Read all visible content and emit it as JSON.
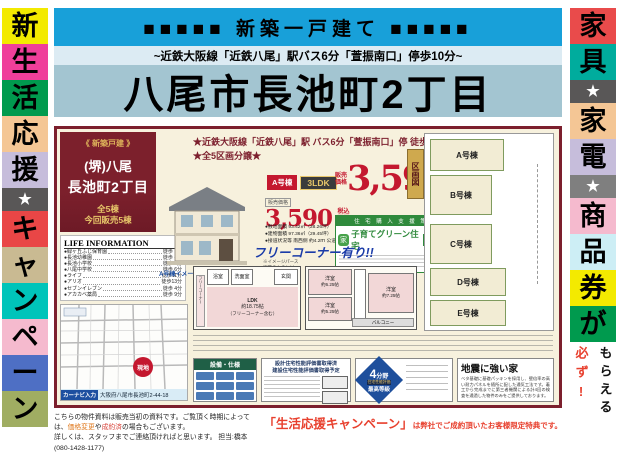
{
  "header": {
    "banner": "■■■■■ 新築一戸建て ■■■■■",
    "subtitle": "~近鉄大阪線「近鉄八尾」駅バス6分「萱振南口」停歩10分~",
    "title": "八尾市長池町2丁目"
  },
  "left_banner": {
    "chars": [
      {
        "ch": "新",
        "bg": "#f3ea00",
        "fg": "#000"
      },
      {
        "ch": "生",
        "bg": "#ef3f9a",
        "fg": "#000"
      },
      {
        "ch": "活",
        "bg": "#009a4e",
        "fg": "#000"
      },
      {
        "ch": "応",
        "bg": "#f4c695",
        "fg": "#000"
      },
      {
        "ch": "援",
        "bg": "#c6bddb",
        "fg": "#000"
      },
      {
        "ch": "★",
        "bg": "#595757",
        "fg": "#fff"
      },
      {
        "ch": "キ",
        "bg": "#e94646",
        "fg": "#000"
      },
      {
        "ch": "ャ",
        "bg": "#c9ba92",
        "fg": "#000"
      },
      {
        "ch": "ン",
        "bg": "#00c4ba",
        "fg": "#000"
      },
      {
        "ch": "ペ",
        "bg": "#f5bace",
        "fg": "#000"
      },
      {
        "ch": "ー",
        "bg": "#4e6fc4",
        "fg": "#000"
      },
      {
        "ch": "ン",
        "bg": "#a0ad62",
        "fg": "#000"
      }
    ]
  },
  "right_banner": {
    "chars": [
      {
        "ch": "家",
        "bg": "#e94b4b",
        "fg": "#000"
      },
      {
        "ch": "具",
        "bg": "#00ac9d",
        "fg": "#000"
      },
      {
        "ch": "★",
        "bg": "#595757",
        "fg": "#fff"
      },
      {
        "ch": "家",
        "bg": "#f4c695",
        "fg": "#000"
      },
      {
        "ch": "電",
        "bg": "#c6bddb",
        "fg": "#000"
      },
      {
        "ch": "★",
        "bg": "#7f7f7f",
        "fg": "#fff"
      },
      {
        "ch": "商",
        "bg": "#f5bace",
        "fg": "#000"
      },
      {
        "ch": "品",
        "bg": "#cdeef5",
        "fg": "#000"
      },
      {
        "ch": "券",
        "bg": "#f3ea00",
        "fg": "#000"
      },
      {
        "ch": "が",
        "bg": "#009a4e",
        "fg": "#000"
      }
    ],
    "tail_red": "必ず!",
    "tail_black": "もらえる"
  },
  "flyer": {
    "panel": {
      "badge": "《 新築戸建 》",
      "line1": "(堺)八尾",
      "line2": "長池町2丁目",
      "count1": "全5棟",
      "count2": "今回販売5棟"
    },
    "life": {
      "title": "LIFE INFORMATION",
      "items": [
        {
          "name": "●緑ヶ丘ふじ保育園",
          "time": "徒歩 9分"
        },
        {
          "name": "●長池幼稚園",
          "time": "徒歩 4分"
        },
        {
          "name": "●長池小学校",
          "time": "徒歩 4分"
        },
        {
          "name": "●八尾中学校",
          "time": "徒歩 6分"
        },
        {
          "name": "●ライフ",
          "time": "徒歩11分"
        },
        {
          "name": "●アリオ",
          "time": "徒歩13分"
        },
        {
          "name": "●セブンイレブン",
          "time": "徒歩 4分"
        },
        {
          "name": "●アカカベ薬局",
          "time": "徒歩 9分"
        }
      ]
    },
    "map": {
      "marker": "現地",
      "navi_label": "カーナビ入力",
      "navi_address": "大阪府八尾市長池町2-44-18"
    },
    "catch1": "★近鉄大阪線「近鉄八尾」駅 バス6分「萱振南口」停 徒歩10分★",
    "catch2": "★全5区画分譲★",
    "house_caption": "A号棟イメージパース",
    "house_note": [
      "※イメージパース",
      "実際のものとは",
      "多少異なります"
    ],
    "unit_badge": "A号棟",
    "plan_badge": "3LDK",
    "small_price": {
      "label": "販売価格",
      "value": "3,590",
      "unit1": "税込",
      "unit2": "万円"
    },
    "specs": [
      "●敷地面積 93.42㎡（28.26坪）",
      "●建物面積 97.36㎡（29.45坪）",
      "●接道状況等 南西側 約4.2ｍ 公道"
    ],
    "big_price": {
      "label1": "販売",
      "label2": "価格",
      "value": "3,590",
      "tax": "(税込)",
      "unit": "万円~"
    },
    "support": {
      "band": "住 宅 購 入 支 援 策",
      "logo": "家",
      "title": "子育てグリーン住宅",
      "sub": "支援事業"
    },
    "free_corner": "フリーコーナー有り!!",
    "kukaku": "区画図",
    "lots": [
      {
        "label": "A号棟"
      },
      {
        "label": "B号棟"
      },
      {
        "label": "C号棟"
      },
      {
        "label": "D号棟"
      },
      {
        "label": "E号棟"
      }
    ],
    "plan1f": {
      "free": "フリーコーナー",
      "bath": "浴室",
      "wash": "洗面室",
      "genkan": "玄関",
      "ldk": "LDK",
      "ldk_size": "約18.75帖",
      "ldk_note": "（フリーコーナー含む）"
    },
    "plan2f": {
      "room1_name": "洋室",
      "room1_size": "約6.25帖",
      "room2_name": "洋室",
      "room2_size": "約5.25帖",
      "room3_name": "洋室",
      "room3_size": "約7.25帖",
      "balcony": "バルコニー"
    },
    "bottom": {
      "equip_title": "設備・仕様",
      "hyoka_line1": "設計住宅性能評価書取得済",
      "hyoka_line2": "建設住宅性能評価書取得予定",
      "badge": {
        "num": "4",
        "field": "分野",
        "band": "住宅性能評価",
        "grade": "最高等級"
      },
      "quake_title": "地震に強い家",
      "quake_body": "ベタ基礎に基礎パッキンを採用し、壁倍率の高い耐力パネルを随所に配した通気工法です。着工から完成までに第三者機関による計4回の検査を通過した物件のみをご提供しております。"
    }
  },
  "footer": {
    "note1_pre": "こちらの物件資料は販売当初の資料です。ご覧頂く時期によっては、",
    "note1_hl1": "価格変更",
    "note1_mid": "や",
    "note1_hl2": "成約済",
    "note1_post": "の場合もございます。",
    "note2": "詳しくは、スタッフまでご連絡頂ければと思います。",
    "staff": "担当:橋本(080-1428-1177)",
    "campaign_head": "「生活応援キャンペーン」",
    "campaign_body": "は弊社でご成約頂いたお客様限定特典です。"
  }
}
